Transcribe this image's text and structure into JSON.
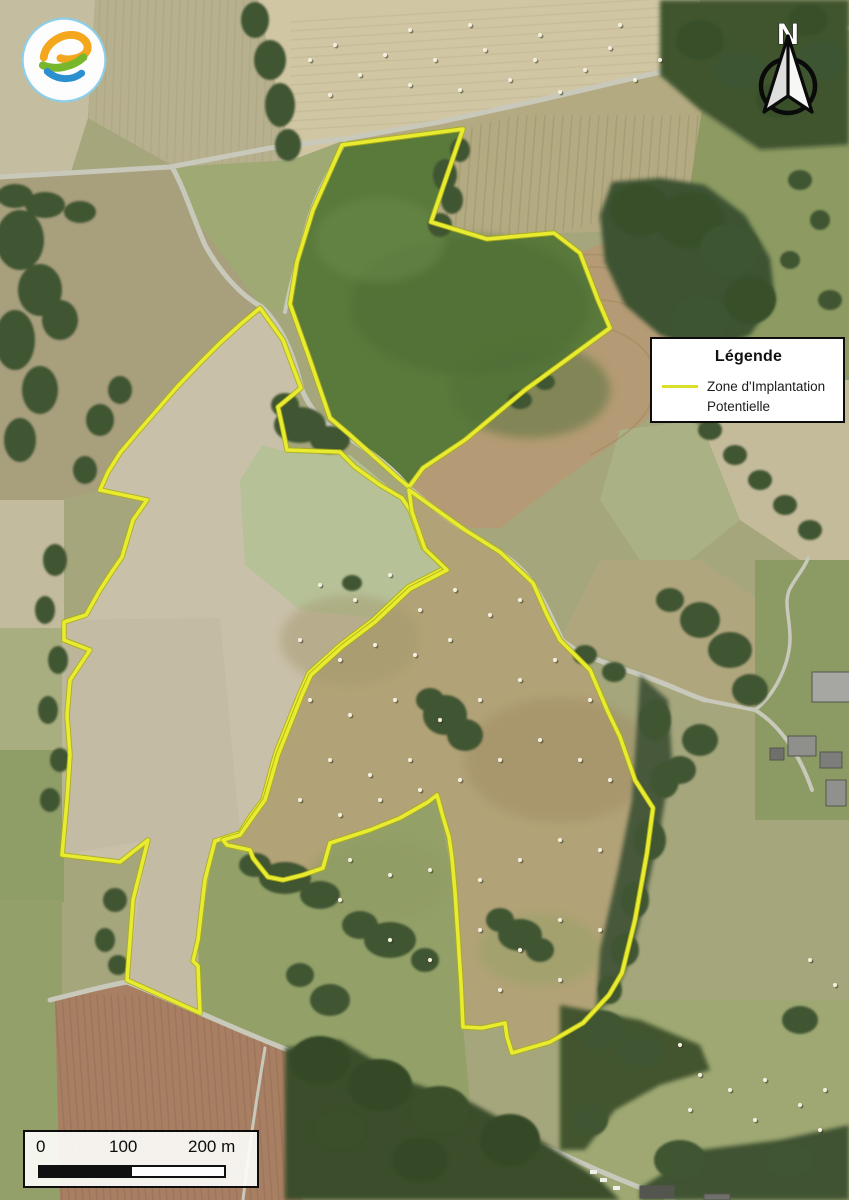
{
  "north_arrow": {
    "label": "N"
  },
  "legend": {
    "title": "Légende",
    "items": [
      {
        "label": "Zone d'Implantation Potentielle",
        "color": "#dbdf2b"
      }
    ]
  },
  "scale_bar": {
    "tick_labels": [
      "0",
      "100",
      "200 m"
    ]
  },
  "logo": {
    "name": "energy-e-logo",
    "ring_color": "#8ecfe8",
    "top_color": "#f4a61d",
    "middle_color": "#78b72b",
    "bottom_color": "#2b8fd0"
  },
  "zip": {
    "name": "Zone d'Implantation Potentielle",
    "outline_color": "#e9eb30",
    "casing_color": "#a8ae14",
    "polygons": [
      [
        [
          342,
          145
        ],
        [
          463,
          129
        ],
        [
          431,
          222
        ],
        [
          487,
          239
        ],
        [
          554,
          233
        ],
        [
          580,
          253
        ],
        [
          598,
          300
        ],
        [
          610,
          328
        ],
        [
          525,
          390
        ],
        [
          465,
          440
        ],
        [
          423,
          468
        ],
        [
          409,
          487
        ],
        [
          398,
          478
        ],
        [
          350,
          435
        ],
        [
          330,
          418
        ],
        [
          310,
          360
        ],
        [
          290,
          304
        ],
        [
          297,
          262
        ],
        [
          313,
          210
        ]
      ],
      [
        [
          260,
          308
        ],
        [
          283,
          340
        ],
        [
          293,
          367
        ],
        [
          301,
          388
        ],
        [
          278,
          407
        ],
        [
          283,
          430
        ],
        [
          287,
          450
        ],
        [
          340,
          452
        ],
        [
          355,
          467
        ],
        [
          380,
          485
        ],
        [
          402,
          498
        ],
        [
          410,
          510
        ],
        [
          423,
          547
        ],
        [
          445,
          568
        ],
        [
          408,
          587
        ],
        [
          373,
          620
        ],
        [
          340,
          645
        ],
        [
          309,
          673
        ],
        [
          300,
          693
        ],
        [
          277,
          750
        ],
        [
          273,
          763
        ],
        [
          263,
          800
        ],
        [
          250,
          817
        ],
        [
          240,
          833
        ],
        [
          215,
          841
        ],
        [
          210,
          860
        ],
        [
          205,
          880
        ],
        [
          198,
          940
        ],
        [
          193,
          961
        ],
        [
          198,
          966
        ],
        [
          200,
          1013
        ],
        [
          127,
          980
        ],
        [
          133,
          900
        ],
        [
          143,
          860
        ],
        [
          148,
          840
        ],
        [
          120,
          862
        ],
        [
          62,
          855
        ],
        [
          67,
          800
        ],
        [
          70,
          755
        ],
        [
          67,
          715
        ],
        [
          70,
          680
        ],
        [
          90,
          650
        ],
        [
          64,
          640
        ],
        [
          64,
          622
        ],
        [
          86,
          615
        ],
        [
          100,
          590
        ],
        [
          113,
          570
        ],
        [
          122,
          557
        ],
        [
          133,
          520
        ],
        [
          147,
          500
        ],
        [
          100,
          490
        ],
        [
          108,
          472
        ],
        [
          120,
          453
        ],
        [
          137,
          433
        ],
        [
          157,
          410
        ],
        [
          177,
          387
        ],
        [
          200,
          363
        ],
        [
          220,
          343
        ],
        [
          242,
          323
        ]
      ],
      [
        [
          409,
          490
        ],
        [
          465,
          530
        ],
        [
          500,
          552
        ],
        [
          533,
          583
        ],
        [
          547,
          615
        ],
        [
          560,
          640
        ],
        [
          590,
          670
        ],
        [
          608,
          712
        ],
        [
          620,
          737
        ],
        [
          635,
          780
        ],
        [
          653,
          808
        ],
        [
          647,
          853
        ],
        [
          635,
          920
        ],
        [
          622,
          973
        ],
        [
          609,
          995
        ],
        [
          583,
          1023
        ],
        [
          550,
          1042
        ],
        [
          512,
          1053
        ],
        [
          507,
          1037
        ],
        [
          505,
          1023
        ],
        [
          482,
          1028
        ],
        [
          463,
          1027
        ],
        [
          461,
          983
        ],
        [
          458,
          937
        ],
        [
          455,
          892
        ],
        [
          452,
          858
        ],
        [
          449,
          837
        ],
        [
          443,
          817
        ],
        [
          437,
          795
        ],
        [
          428,
          802
        ],
        [
          400,
          818
        ],
        [
          370,
          830
        ],
        [
          330,
          843
        ],
        [
          323,
          868
        ],
        [
          303,
          875
        ],
        [
          283,
          880
        ],
        [
          268,
          877
        ],
        [
          253,
          858
        ],
        [
          250,
          850
        ],
        [
          227,
          845
        ],
        [
          223,
          840
        ],
        [
          240,
          835
        ],
        [
          252,
          818
        ],
        [
          265,
          800
        ],
        [
          278,
          755
        ],
        [
          302,
          695
        ],
        [
          311,
          675
        ],
        [
          342,
          647
        ],
        [
          375,
          622
        ],
        [
          410,
          589
        ],
        [
          447,
          570
        ],
        [
          425,
          549
        ],
        [
          412,
          512
        ]
      ]
    ],
    "lobe_fill_colors": [
      "#5a7a3c",
      "#c9c0a9",
      "#b2a277"
    ]
  },
  "map_features": {
    "hay_bales_top_field": [
      [
        310,
        60
      ],
      [
        335,
        45
      ],
      [
        360,
        75
      ],
      [
        385,
        55
      ],
      [
        410,
        85
      ],
      [
        435,
        60
      ],
      [
        460,
        90
      ],
      [
        485,
        50
      ],
      [
        510,
        80
      ],
      [
        535,
        60
      ],
      [
        560,
        92
      ],
      [
        585,
        70
      ],
      [
        610,
        48
      ],
      [
        635,
        80
      ],
      [
        660,
        60
      ],
      [
        330,
        95
      ],
      [
        410,
        30
      ],
      [
        470,
        25
      ],
      [
        540,
        35
      ],
      [
        620,
        25
      ]
    ],
    "hay_bales_lower_zone": [
      [
        320,
        585
      ],
      [
        355,
        600
      ],
      [
        390,
        575
      ],
      [
        420,
        610
      ],
      [
        455,
        590
      ],
      [
        300,
        640
      ],
      [
        340,
        660
      ],
      [
        375,
        645
      ],
      [
        415,
        655
      ],
      [
        450,
        640
      ],
      [
        490,
        615
      ],
      [
        520,
        600
      ],
      [
        310,
        700
      ],
      [
        350,
        715
      ],
      [
        395,
        700
      ],
      [
        440,
        720
      ],
      [
        480,
        700
      ],
      [
        520,
        680
      ],
      [
        555,
        660
      ],
      [
        590,
        700
      ],
      [
        330,
        760
      ],
      [
        370,
        775
      ],
      [
        410,
        760
      ],
      [
        300,
        800
      ],
      [
        340,
        815
      ],
      [
        380,
        800
      ],
      [
        420,
        790
      ],
      [
        460,
        780
      ],
      [
        500,
        760
      ],
      [
        540,
        740
      ],
      [
        580,
        760
      ],
      [
        610,
        780
      ],
      [
        350,
        860
      ],
      [
        390,
        875
      ],
      [
        430,
        870
      ],
      [
        480,
        880
      ],
      [
        520,
        860
      ],
      [
        560,
        840
      ],
      [
        600,
        850
      ],
      [
        480,
        930
      ],
      [
        520,
        950
      ],
      [
        560,
        920
      ],
      [
        430,
        960
      ],
      [
        390,
        940
      ],
      [
        340,
        900
      ],
      [
        600,
        930
      ],
      [
        560,
        980
      ],
      [
        500,
        990
      ]
    ],
    "hay_bales_southeast": [
      [
        700,
        1075
      ],
      [
        730,
        1090
      ],
      [
        765,
        1080
      ],
      [
        800,
        1105
      ],
      [
        825,
        1090
      ],
      [
        690,
        1110
      ],
      [
        755,
        1120
      ],
      [
        820,
        1130
      ],
      [
        680,
        1045
      ],
      [
        810,
        960
      ],
      [
        835,
        985
      ]
    ],
    "buildings": [
      [
        812,
        672,
        38,
        30,
        "#a6a6a2"
      ],
      [
        788,
        736,
        28,
        20,
        "#8f8f8b"
      ],
      [
        820,
        752,
        22,
        16,
        "#7d7d79"
      ],
      [
        826,
        780,
        20,
        26,
        "#90908c"
      ],
      [
        770,
        748,
        14,
        12,
        "#6f6f6b"
      ],
      [
        640,
        1186,
        34,
        12,
        "#55554f"
      ],
      [
        704,
        1194,
        26,
        6,
        "#6f6f6b"
      ]
    ],
    "vehicles": [
      [
        600,
        1178
      ],
      [
        613,
        1186
      ],
      [
        590,
        1170
      ]
    ]
  }
}
